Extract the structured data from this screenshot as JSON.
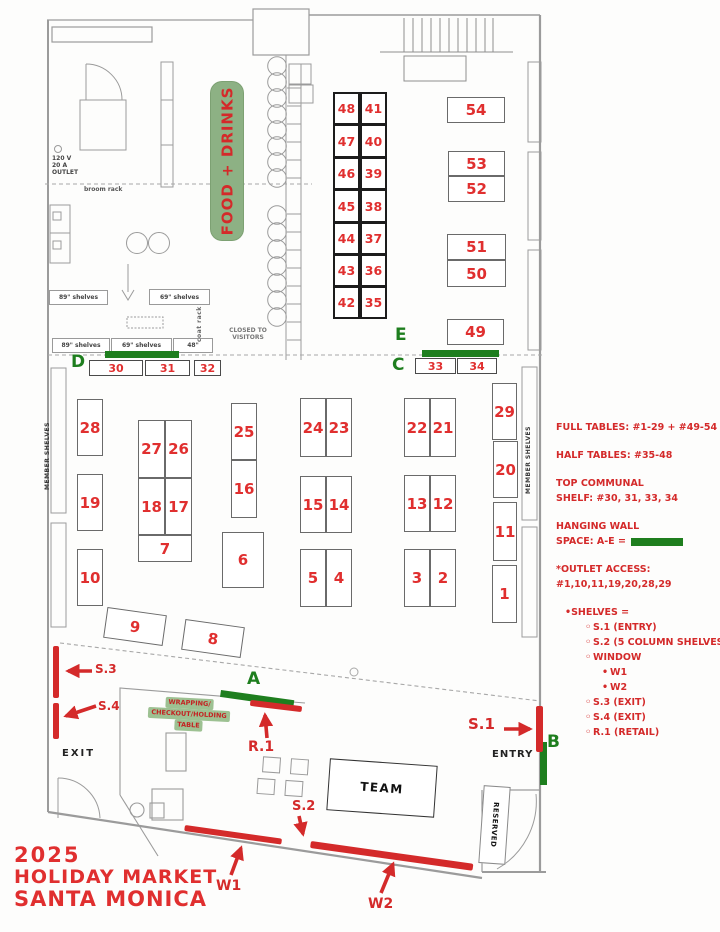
{
  "title": {
    "line1": "2025",
    "line2": "HOLIDAY MARKET",
    "line3": "SANTA MONICA"
  },
  "banner": {
    "label": "FOOD + DRINKS"
  },
  "colors": {
    "red": "#d42a2a",
    "green": "#1e7e1e",
    "banner_green": "#8db184",
    "wall_gray": "#9b9b9b"
  },
  "legend": {
    "full_tables": "FULL TABLES: #1-29 + #49-54",
    "half_tables": "HALF TABLES: #35-48",
    "communal_line1": "TOP COMMUNAL",
    "communal_line2": "SHELF: #30, 31, 33, 34",
    "hanging_line1": "HANGING WALL",
    "hanging_line2": "SPACE: A-E =",
    "outlet_line1": "*OUTLET ACCESS:",
    "outlet_line2": "#1,10,11,19,20,28,29",
    "shelves_header": "SHELVES =",
    "shelves_list": [
      {
        "label": "S.1 (ENTRY)",
        "level": 1
      },
      {
        "label": "S.2 (5 COLUMN SHELVES)",
        "level": 1
      },
      {
        "label": "WINDOW",
        "level": 1
      },
      {
        "label": "W1",
        "level": 2
      },
      {
        "label": "W2",
        "level": 2
      },
      {
        "label": "S.3 (EXIT)",
        "level": 1
      },
      {
        "label": "S.4 (EXIT)",
        "level": 1
      },
      {
        "label": "R.1 (RETAIL)",
        "level": 1
      }
    ]
  },
  "markers": {
    "s1": {
      "label": "S.1"
    },
    "s2": {
      "label": "S.2"
    },
    "s3": {
      "label": "S.3"
    },
    "s4": {
      "label": "S.4"
    },
    "r1": {
      "label": "R.1"
    },
    "w1": {
      "label": "W1"
    },
    "w2": {
      "label": "W2"
    }
  },
  "hanging_spaces": [
    {
      "label": "A",
      "lx": 247,
      "ly": 671,
      "bar": [
        221,
        690,
        74,
        7,
        8
      ]
    },
    {
      "label": "B",
      "lx": 547,
      "ly": 734,
      "bar": [
        540,
        742,
        7,
        43,
        0
      ]
    },
    {
      "label": "C",
      "lx": 392,
      "ly": 357,
      "bar": null
    },
    {
      "label": "D",
      "lx": 71,
      "ly": 354,
      "bar": [
        105,
        351,
        74,
        7,
        0
      ]
    },
    {
      "label": "E",
      "lx": 395,
      "ly": 327,
      "bar": [
        422,
        350,
        77,
        7,
        0
      ]
    }
  ],
  "tables": [
    {
      "label": "48",
      "cls": "half",
      "x": 333,
      "y": 92,
      "w": 27,
      "h": 33
    },
    {
      "label": "41",
      "cls": "half",
      "x": 360,
      "y": 92,
      "w": 27,
      "h": 33
    },
    {
      "label": "47",
      "cls": "half",
      "x": 333,
      "y": 124,
      "w": 27,
      "h": 34
    },
    {
      "label": "40",
      "cls": "half",
      "x": 360,
      "y": 124,
      "w": 27,
      "h": 34
    },
    {
      "label": "46",
      "cls": "half",
      "x": 333,
      "y": 157,
      "w": 27,
      "h": 33
    },
    {
      "label": "39",
      "cls": "half",
      "x": 360,
      "y": 157,
      "w": 27,
      "h": 33
    },
    {
      "label": "45",
      "cls": "half",
      "x": 333,
      "y": 189,
      "w": 27,
      "h": 34
    },
    {
      "label": "38",
      "cls": "half",
      "x": 360,
      "y": 189,
      "w": 27,
      "h": 34
    },
    {
      "label": "44",
      "cls": "half",
      "x": 333,
      "y": 222,
      "w": 27,
      "h": 33
    },
    {
      "label": "37",
      "cls": "half",
      "x": 360,
      "y": 222,
      "w": 27,
      "h": 33
    },
    {
      "label": "43",
      "cls": "half",
      "x": 333,
      "y": 254,
      "w": 27,
      "h": 33
    },
    {
      "label": "36",
      "cls": "half",
      "x": 360,
      "y": 254,
      "w": 27,
      "h": 33
    },
    {
      "label": "42",
      "cls": "half",
      "x": 333,
      "y": 286,
      "w": 27,
      "h": 33
    },
    {
      "label": "35",
      "cls": "half",
      "x": 360,
      "y": 286,
      "w": 27,
      "h": 33
    },
    {
      "label": "54",
      "cls": "full",
      "x": 447,
      "y": 97,
      "w": 58,
      "h": 26
    },
    {
      "label": "53",
      "cls": "full",
      "x": 448,
      "y": 151,
      "w": 57,
      "h": 25
    },
    {
      "label": "52",
      "cls": "full",
      "x": 448,
      "y": 176,
      "w": 57,
      "h": 26
    },
    {
      "label": "51",
      "cls": "full",
      "x": 447,
      "y": 234,
      "w": 59,
      "h": 26
    },
    {
      "label": "50",
      "cls": "full",
      "x": 447,
      "y": 260,
      "w": 59,
      "h": 27
    },
    {
      "label": "49",
      "cls": "full",
      "x": 447,
      "y": 319,
      "w": 57,
      "h": 26
    },
    {
      "label": "30",
      "cls": "shelfbox",
      "x": 89,
      "y": 360,
      "w": 54,
      "h": 16
    },
    {
      "label": "31",
      "cls": "shelfbox",
      "x": 145,
      "y": 360,
      "w": 45,
      "h": 16
    },
    {
      "label": "32",
      "cls": "shelfbox",
      "x": 194,
      "y": 360,
      "w": 27,
      "h": 16
    },
    {
      "label": "33",
      "cls": "shelfbox",
      "x": 415,
      "y": 358,
      "w": 41,
      "h": 16
    },
    {
      "label": "34",
      "cls": "shelfbox",
      "x": 457,
      "y": 358,
      "w": 40,
      "h": 16
    },
    {
      "label": "28",
      "cls": "full",
      "x": 77,
      "y": 399,
      "w": 26,
      "h": 57
    },
    {
      "label": "19",
      "cls": "full",
      "x": 77,
      "y": 474,
      "w": 26,
      "h": 57
    },
    {
      "label": "10",
      "cls": "full",
      "x": 77,
      "y": 549,
      "w": 26,
      "h": 57
    },
    {
      "label": "27",
      "cls": "full",
      "x": 138,
      "y": 420,
      "w": 27,
      "h": 58
    },
    {
      "label": "26",
      "cls": "full",
      "x": 165,
      "y": 420,
      "w": 27,
      "h": 58
    },
    {
      "label": "18",
      "cls": "full",
      "x": 138,
      "y": 478,
      "w": 27,
      "h": 57
    },
    {
      "label": "17",
      "cls": "full",
      "x": 165,
      "y": 478,
      "w": 27,
      "h": 57
    },
    {
      "label": "7",
      "cls": "full",
      "x": 138,
      "y": 535,
      "w": 54,
      "h": 27
    },
    {
      "label": "25",
      "cls": "full",
      "x": 231,
      "y": 403,
      "w": 26,
      "h": 57
    },
    {
      "label": "16",
      "cls": "full",
      "x": 231,
      "y": 460,
      "w": 26,
      "h": 58
    },
    {
      "label": "6",
      "cls": "full",
      "x": 222,
      "y": 532,
      "w": 42,
      "h": 56
    },
    {
      "label": "24",
      "cls": "full",
      "x": 300,
      "y": 398,
      "w": 26,
      "h": 59
    },
    {
      "label": "23",
      "cls": "full",
      "x": 326,
      "y": 398,
      "w": 26,
      "h": 59
    },
    {
      "label": "15",
      "cls": "full",
      "x": 300,
      "y": 476,
      "w": 26,
      "h": 57
    },
    {
      "label": "14",
      "cls": "full",
      "x": 326,
      "y": 476,
      "w": 26,
      "h": 57
    },
    {
      "label": "5",
      "cls": "full",
      "x": 300,
      "y": 549,
      "w": 26,
      "h": 58
    },
    {
      "label": "4",
      "cls": "full",
      "x": 326,
      "y": 549,
      "w": 26,
      "h": 58
    },
    {
      "label": "22",
      "cls": "full",
      "x": 404,
      "y": 398,
      "w": 26,
      "h": 59
    },
    {
      "label": "21",
      "cls": "full",
      "x": 430,
      "y": 398,
      "w": 26,
      "h": 59
    },
    {
      "label": "13",
      "cls": "full",
      "x": 404,
      "y": 475,
      "w": 26,
      "h": 57
    },
    {
      "label": "12",
      "cls": "full",
      "x": 430,
      "y": 475,
      "w": 26,
      "h": 57
    },
    {
      "label": "3",
      "cls": "full",
      "x": 404,
      "y": 549,
      "w": 26,
      "h": 58
    },
    {
      "label": "2",
      "cls": "full",
      "x": 430,
      "y": 549,
      "w": 26,
      "h": 58
    },
    {
      "label": "29",
      "cls": "full",
      "x": 492,
      "y": 383,
      "w": 25,
      "h": 57
    },
    {
      "label": "20",
      "cls": "full",
      "x": 493,
      "y": 441,
      "w": 25,
      "h": 57
    },
    {
      "label": "11",
      "cls": "full",
      "x": 493,
      "y": 502,
      "w": 24,
      "h": 59
    },
    {
      "label": "1",
      "cls": "full",
      "x": 492,
      "y": 565,
      "w": 25,
      "h": 58
    },
    {
      "label": "9",
      "cls": "full",
      "x": 105,
      "y": 611,
      "w": 60,
      "h": 31,
      "rot": 8
    },
    {
      "label": "8",
      "cls": "full",
      "x": 183,
      "y": 623,
      "w": 60,
      "h": 31,
      "rot": 8
    }
  ],
  "shelf_label_boxes": [
    {
      "label": "89\" shelves",
      "x": 49,
      "y": 290,
      "w": 59,
      "h": 15
    },
    {
      "label": "69\" shelves",
      "x": 149,
      "y": 289,
      "w": 61,
      "h": 16
    },
    {
      "label": "89\" shelves",
      "x": 52,
      "y": 338,
      "w": 58,
      "h": 15
    },
    {
      "label": "69\" shelves",
      "x": 111,
      "y": 338,
      "w": 61,
      "h": 15
    },
    {
      "label": "48\"",
      "x": 173,
      "y": 338,
      "w": 40,
      "h": 15
    }
  ],
  "plan": {
    "outlet": [
      "120 V",
      "20 A",
      "OUTLET"
    ],
    "broom_rack": "broom rack",
    "coat_rack": "coat rack",
    "closed_line1": "CLOSED TO",
    "closed_line2": "VISITORS",
    "member_shelves": "MEMBER SHELVES",
    "exit": "EXIT",
    "entry": "ENTRY",
    "team": "TEAM",
    "reserved": "RESERVED",
    "wrap_line1": "WRAPPING/",
    "wrap_line2": "CHECKOUT/HOLDING",
    "wrap_line3": "TABLE"
  }
}
